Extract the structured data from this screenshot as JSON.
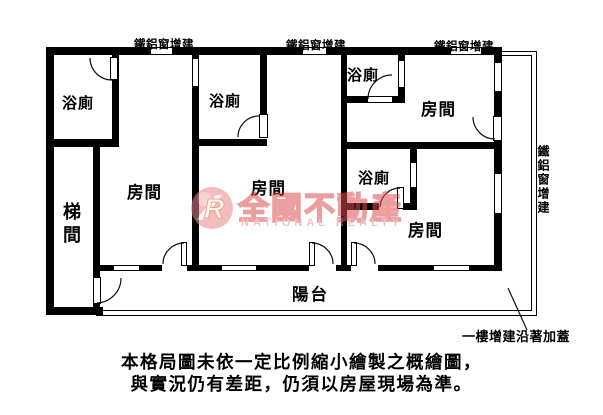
{
  "rooms": {
    "bath1": "浴廁",
    "bath2": "浴廁",
    "bath3": "浴廁",
    "bath4": "浴廁",
    "room1": "房間",
    "room2": "房間",
    "room3": "房間",
    "room4": "房間",
    "stairwell": "梯間",
    "balcony": "陽台"
  },
  "annotations": {
    "window_addition_top_1": "鐵鋁窗增建",
    "window_addition_top_2": "鐵鋁窗增建",
    "window_addition_top_3": "鐵鋁窗增建",
    "window_addition_right": "鐵鋁窗增建",
    "ground_floor_addition": "一樓增建沿著加蓋"
  },
  "watermark": {
    "logo_letter": "R",
    "brand_zh": "全國不動產",
    "brand_en": "NATIONAL REALTY"
  },
  "disclaimer": {
    "line1": "本格局圖未依一定比例縮小繪製之概繪圖，",
    "line2": "與實況仍有差距，仍須以房屋現場為準。"
  },
  "colors": {
    "wall": "#000000",
    "watermark_pink": "#ec8888",
    "watermark_red": "#dd4f4f",
    "background": "#ffffff"
  }
}
